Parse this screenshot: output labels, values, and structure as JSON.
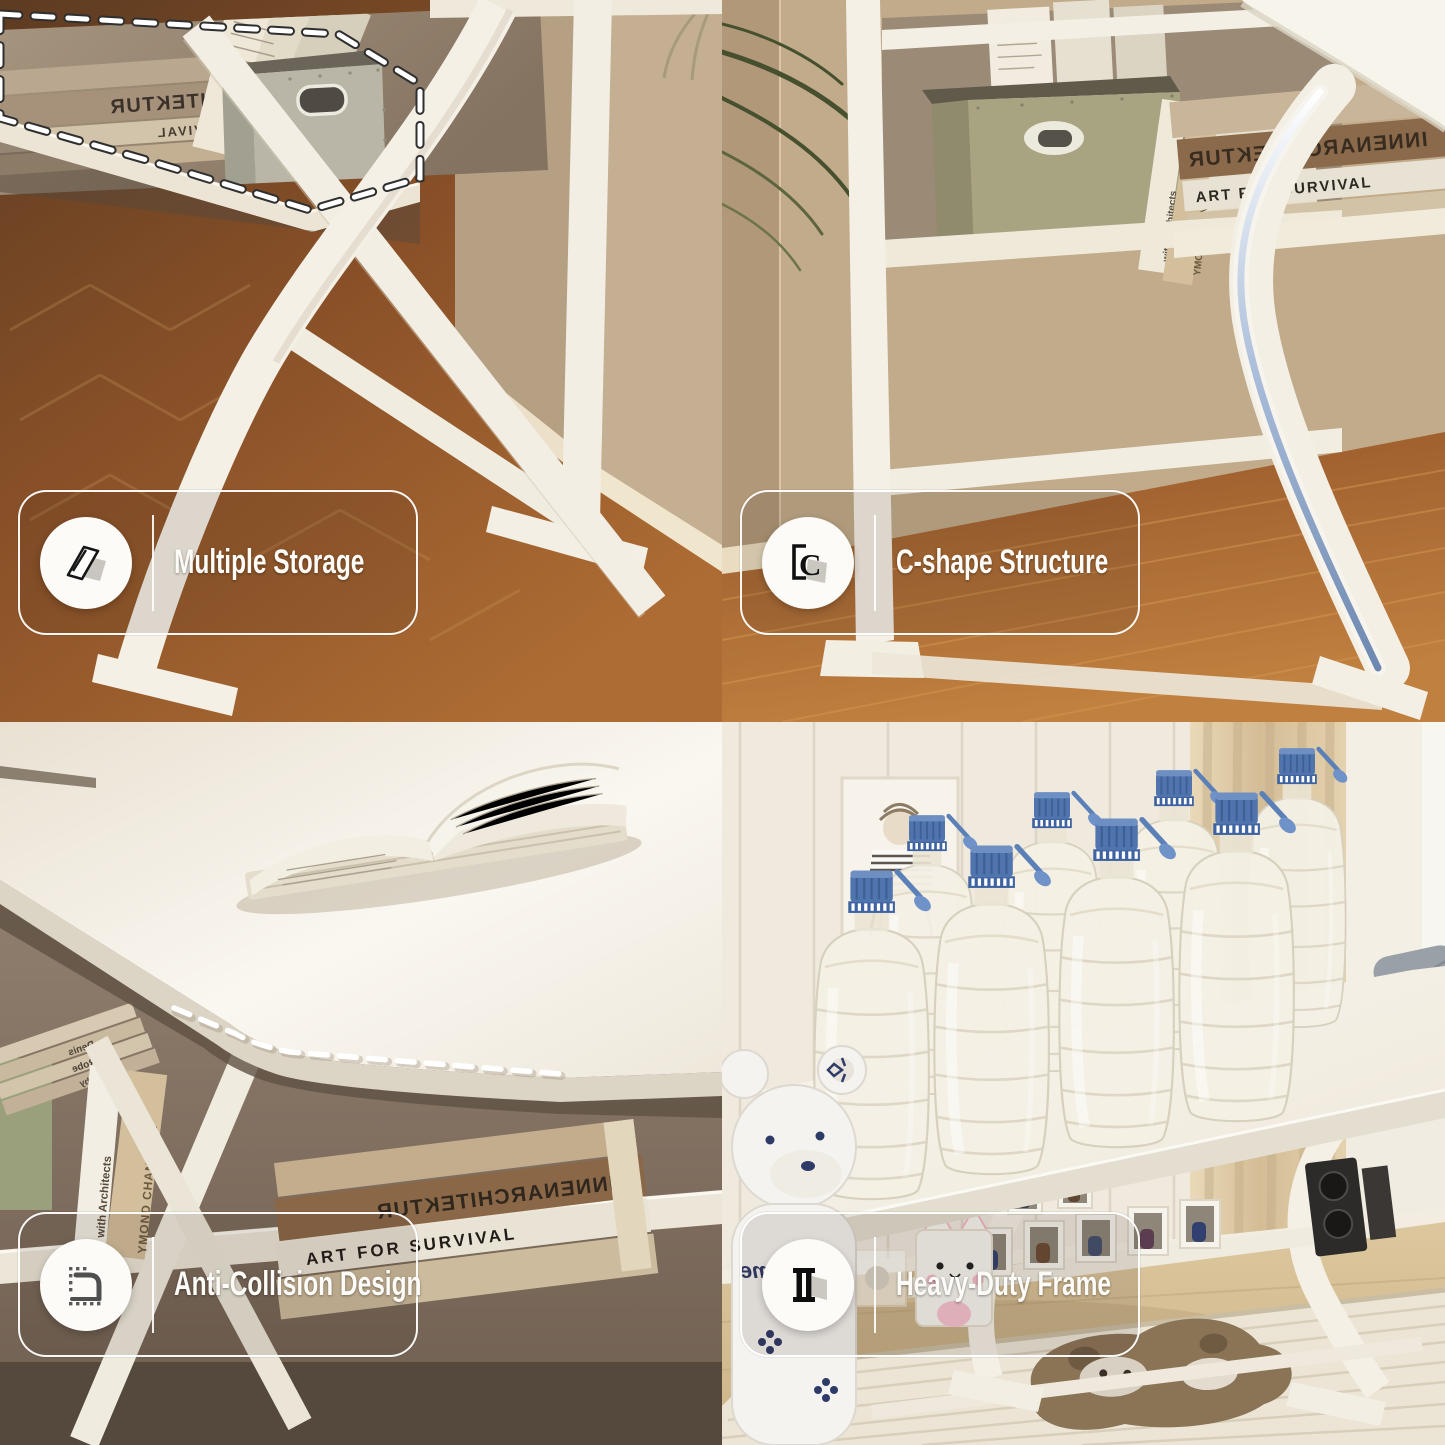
{
  "features": {
    "multiple_storage": {
      "label": "Multiple Storage",
      "icon": "layers-icon"
    },
    "c_shape": {
      "label": "C-shape Structure",
      "icon": "c-bracket-icon"
    },
    "anti_collision": {
      "label": "Anti-Collision Design",
      "icon": "rounded-corner-icon"
    },
    "heavy_duty": {
      "label": "Heavy-Duty Frame",
      "icon": "column-icon"
    }
  },
  "icons": {
    "c_shape_glyph": "C"
  },
  "photos": {
    "top_left": {
      "book_spine_1": "INNENARCHITEKTUR",
      "book_spine_2": "ART FOR SURVIVAL"
    },
    "top_right": {
      "book_spine_1": "INNENARCHITEKTUR",
      "book_spine_2": "ART FOR SURVIVAL",
      "book_spine_vertical_1": "with Architects",
      "book_spine_vertical_2": "YMOND CHANDLER"
    },
    "bottom_left": {
      "book_spine_1": "INNENARCHITEKTUR",
      "book_spine_2": "ART FOR SURVIVAL",
      "book_spine_vertical_1": "with Architects",
      "book_spine_vertical_2": "YMOND CHANDLER",
      "book_spine_small_1": "Denis",
      "book_spine_small_2": "Robe",
      "book_spine_small_3": "by"
    },
    "bottom_right": {
      "figurine_text": "Supreme"
    }
  },
  "colors": {
    "pill_border": "#ffffff",
    "label_text": "#fcfbf7",
    "desk_white": "#f6f3ea",
    "wood_floor_dark": "#6a4426",
    "wood_floor_warm": "#b06c33",
    "wall_tan": "#c3ac8c",
    "sage_box": "#a8a482",
    "bottle_cap_blue": "#4f74ae",
    "highlight_blue": "#8fa8cc",
    "navy_accent": "#2e3a68"
  }
}
